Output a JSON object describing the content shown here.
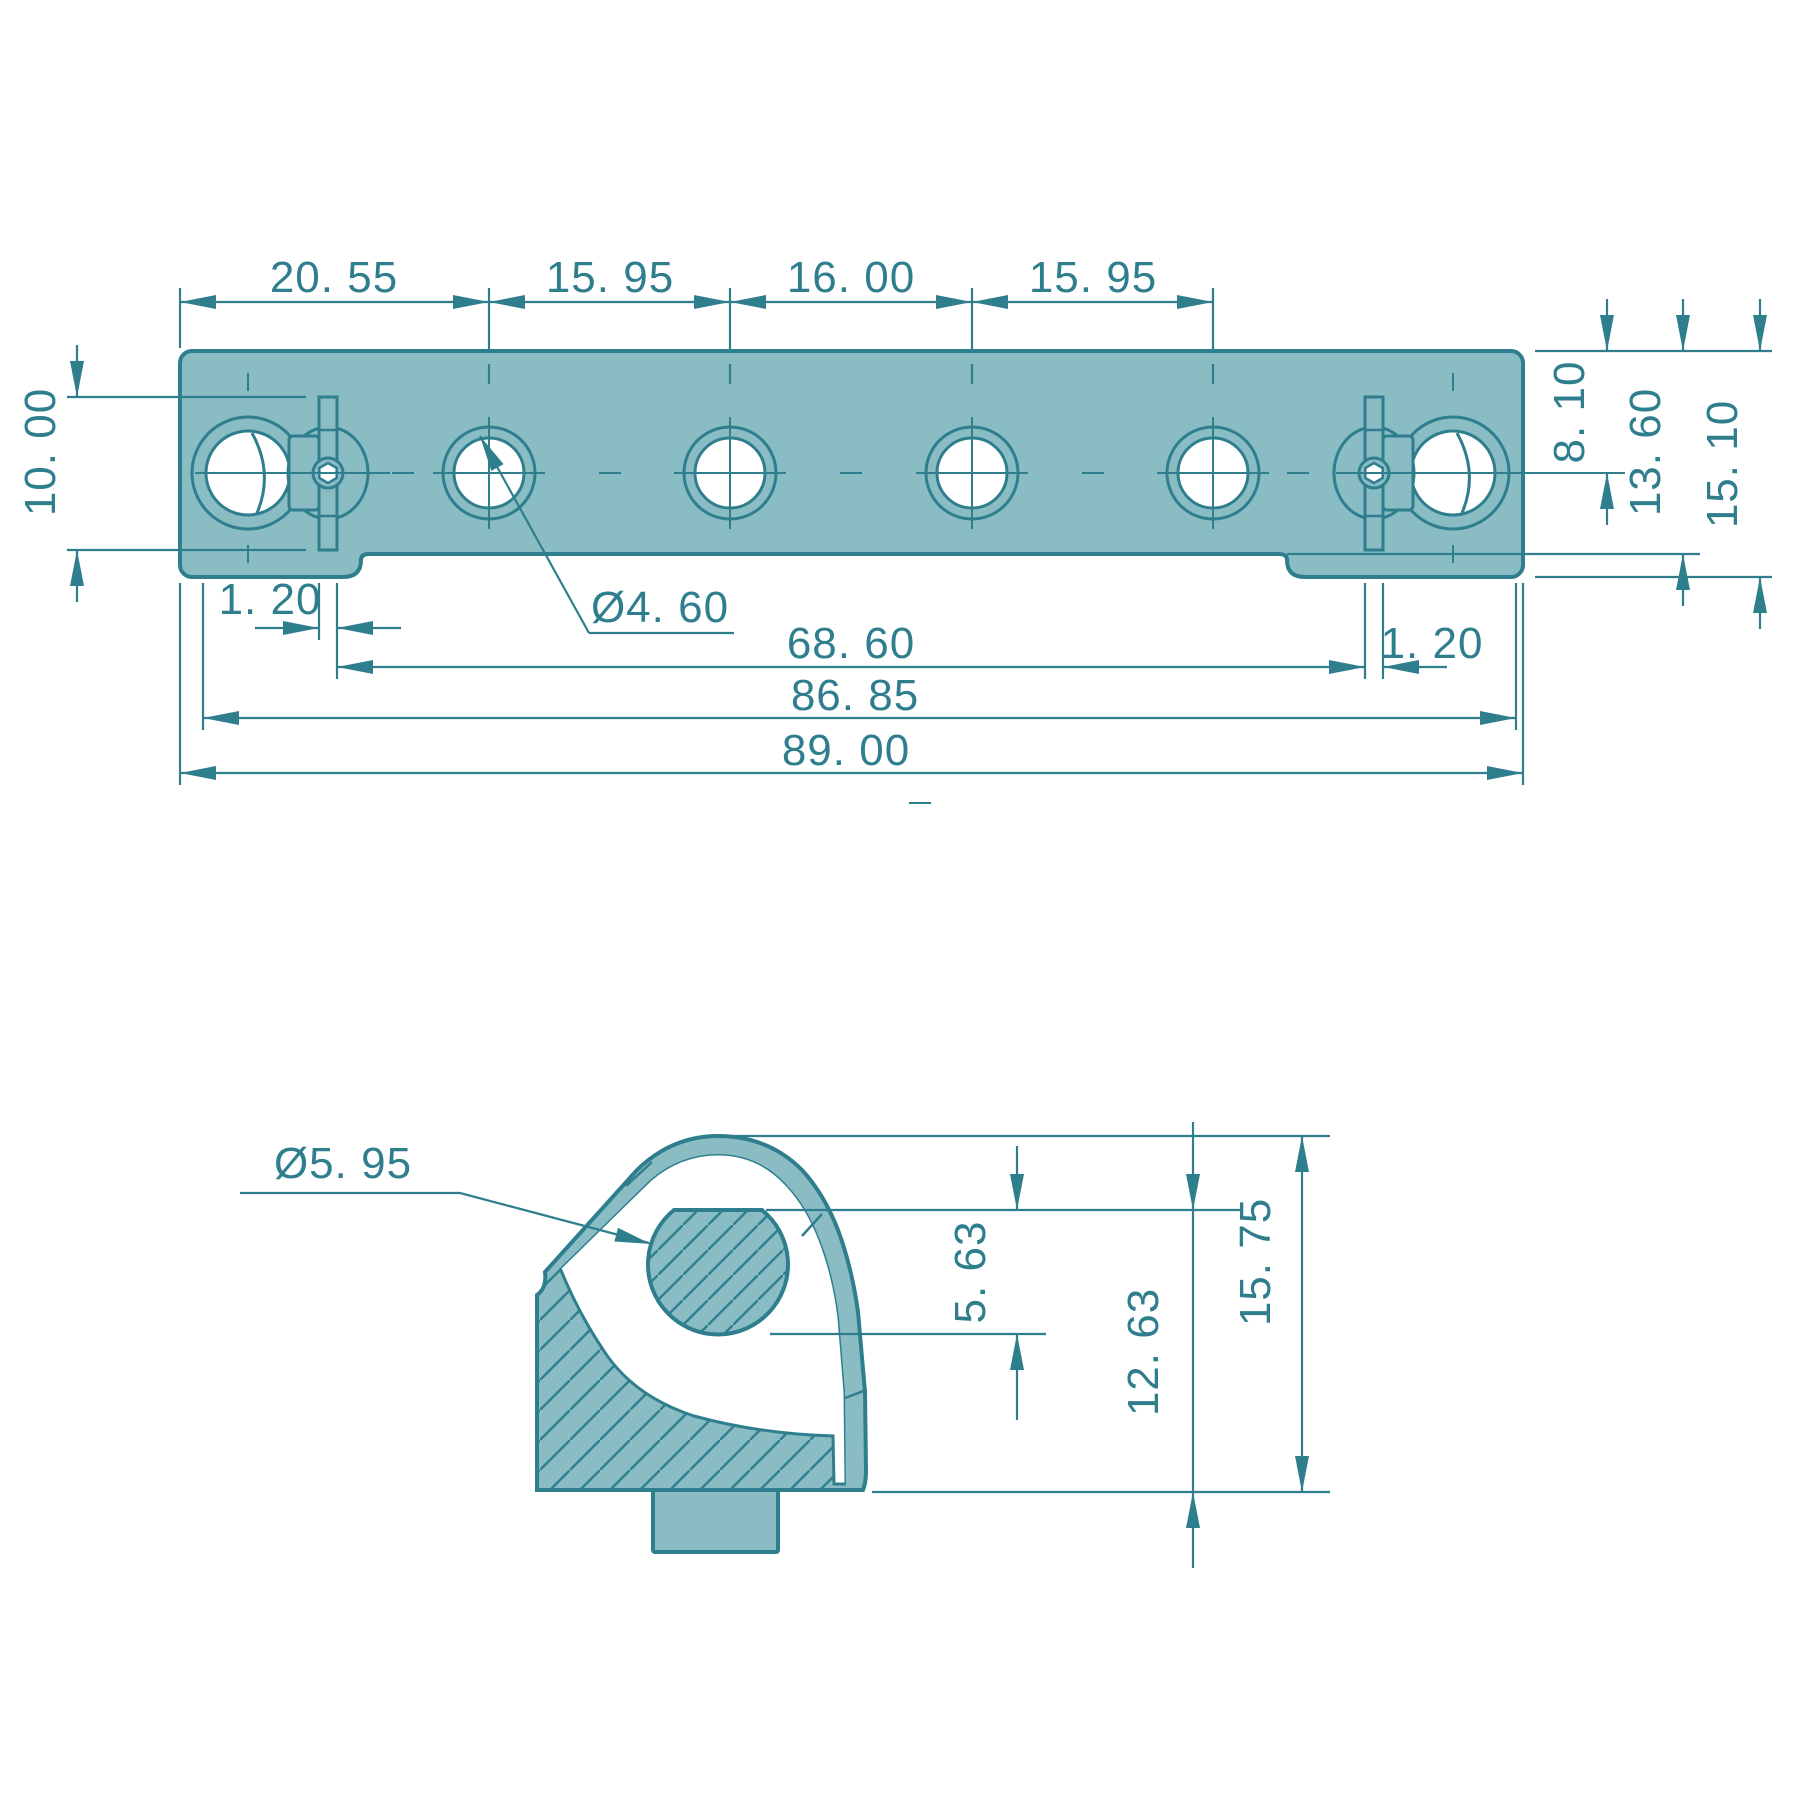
{
  "drawing": {
    "type": "2-view mechanical part drawing (slotted mounting bar with keyhole latches, and cross-section)",
    "colors": {
      "line": "#2f7e8e",
      "fill": "#8abcc4",
      "background": "#ffffff",
      "text": "#2f7e8e"
    }
  },
  "views": {
    "top_view": {
      "label": "top-view-of-bar",
      "hole_count_small": 4,
      "keyhole_count": 2
    },
    "section_view": {
      "label": "cross-section-of-end-hook"
    }
  },
  "dims": {
    "spacing_1": "20. 55",
    "spacing_2": "15. 95",
    "spacing_3": "16. 00",
    "spacing_4": "15. 95",
    "slot_height": "10. 00",
    "height_to_center": "8. 10",
    "height_to_step": "13. 60",
    "height_total": "15. 10",
    "tab_offset_left": "1. 20",
    "tab_offset_right": "1. 20",
    "hole_diameter": "Ø4. 60",
    "length_inner": "68. 60",
    "length_mid": "86. 85",
    "length_overall": "89. 00",
    "pin_diameter": "Ø5. 95",
    "pin_height": "5. 63",
    "section_mid_height": "12. 63",
    "section_total_height": "15. 75"
  }
}
